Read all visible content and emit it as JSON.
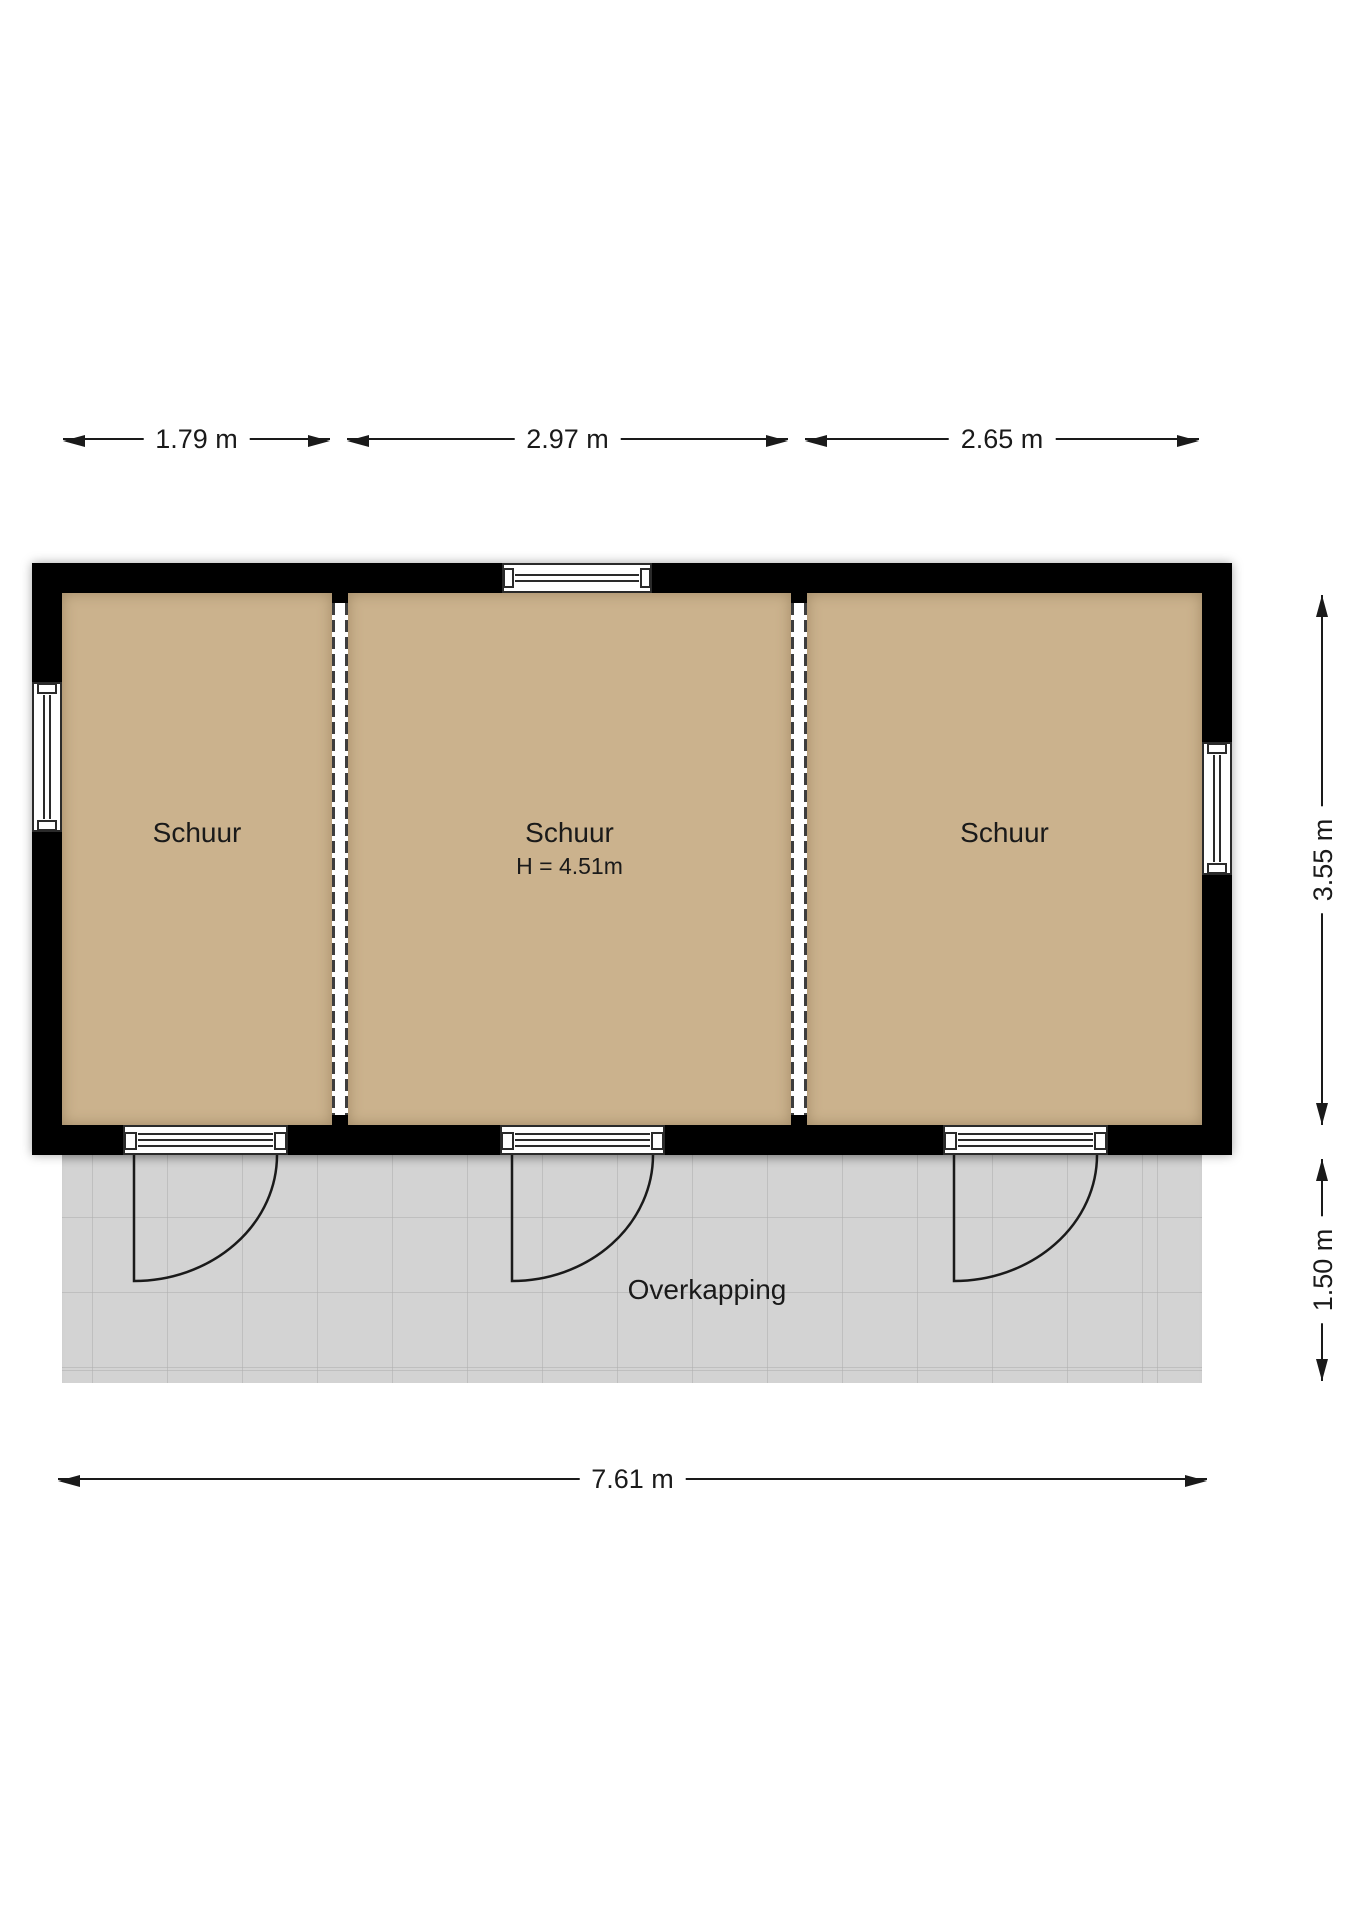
{
  "floorplan": {
    "rooms": [
      {
        "label": "Schuur"
      },
      {
        "label": "Schuur",
        "ceiling_height": "H = 4.51m"
      },
      {
        "label": "Schuur"
      }
    ],
    "canopy": {
      "label": "Overkapping"
    }
  },
  "dimensions": {
    "top": [
      "1.79 m",
      "2.97 m",
      "2.65 m"
    ],
    "right": [
      "3.55 m",
      "1.50 m"
    ],
    "bottom": [
      "7.61 m"
    ]
  },
  "colors": {
    "wall": "#000000",
    "room_floor": "#cbb28d",
    "canopy_floor": "#d3d3d3",
    "dimension_line": "#1a1a1a"
  }
}
